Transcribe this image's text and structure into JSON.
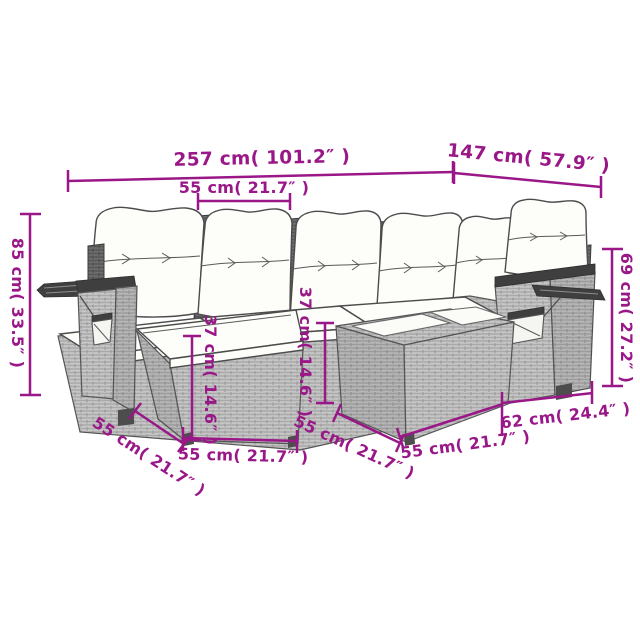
{
  "colors": {
    "background": "#ffffff",
    "dimension_accent": "#9a1788",
    "wicker_light": "#c7c7c7",
    "wicker_dark": "#3f3f3f",
    "furniture_outline": "#4c4c4c",
    "cushion_fill": "#fdfdfa"
  },
  "dims": {
    "total_width": "257 cm( 101.2″ )",
    "right_depth": "147 cm( 57.9″ )",
    "seat_width": "55 cm( 21.7″ )",
    "total_height": "85 cm( 33.5″ )",
    "armrest_height": "69 cm( 27.2″ )",
    "ottoman_height": "37 cm( 14.6″ )",
    "table_height": "37 cm( 14.6″ )",
    "ottoman_depth": "55 cm( 21.7″ )",
    "ottoman_width": "55 cm( 21.7″ )",
    "table_depth": "55 cm( 21.7″ )",
    "table_width": "55 cm( 21.7″ )",
    "side_depth": "62 cm( 24.4″ )"
  }
}
